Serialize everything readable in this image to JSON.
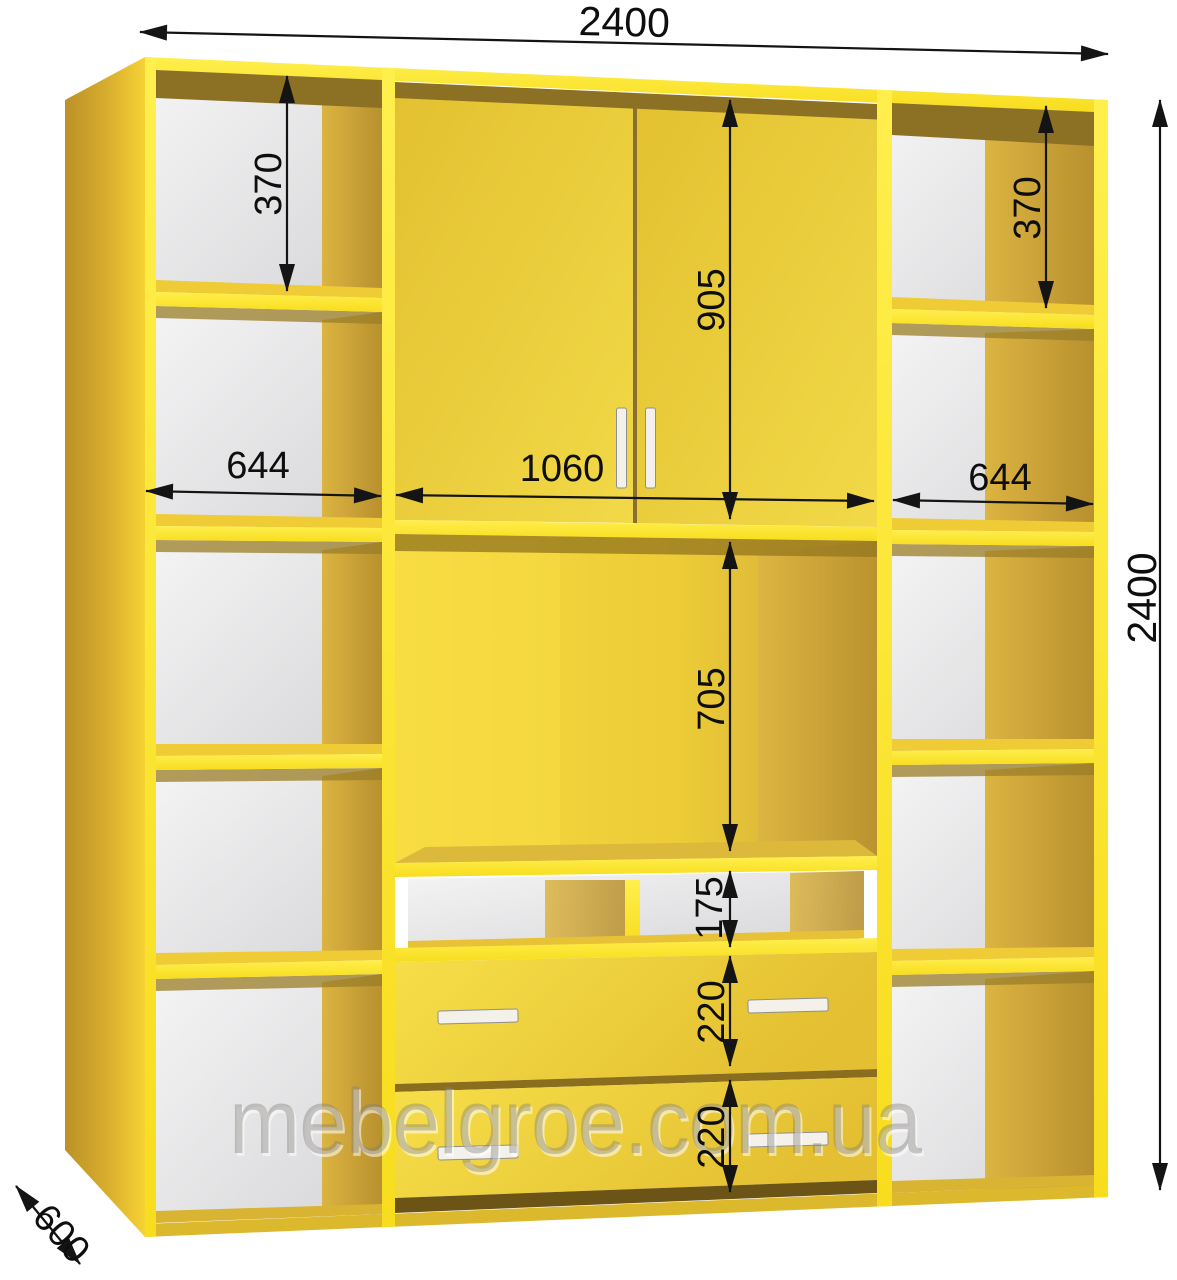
{
  "drawing": {
    "type": "furniture-dimension-diagram",
    "subject": "wardrobe-wall-unit",
    "watermark": "mebelgroe.com.ua",
    "units": "mm",
    "accent_color": "#ffe62b",
    "dimension_line_color": "#141414",
    "back_panel_color": "#e4e4e6",
    "dimensions": {
      "total_width": "2400",
      "total_height": "2400",
      "depth": "600",
      "left_top_compartment_height": "370",
      "right_top_compartment_height": "370",
      "left_column_width": "644",
      "right_column_width": "644",
      "center_section_width": "1060",
      "upper_doors_height": "905",
      "tv_niche_height": "705",
      "shelf_row_height": "175",
      "upper_drawer_height": "220",
      "lower_drawer_height": "220"
    }
  }
}
